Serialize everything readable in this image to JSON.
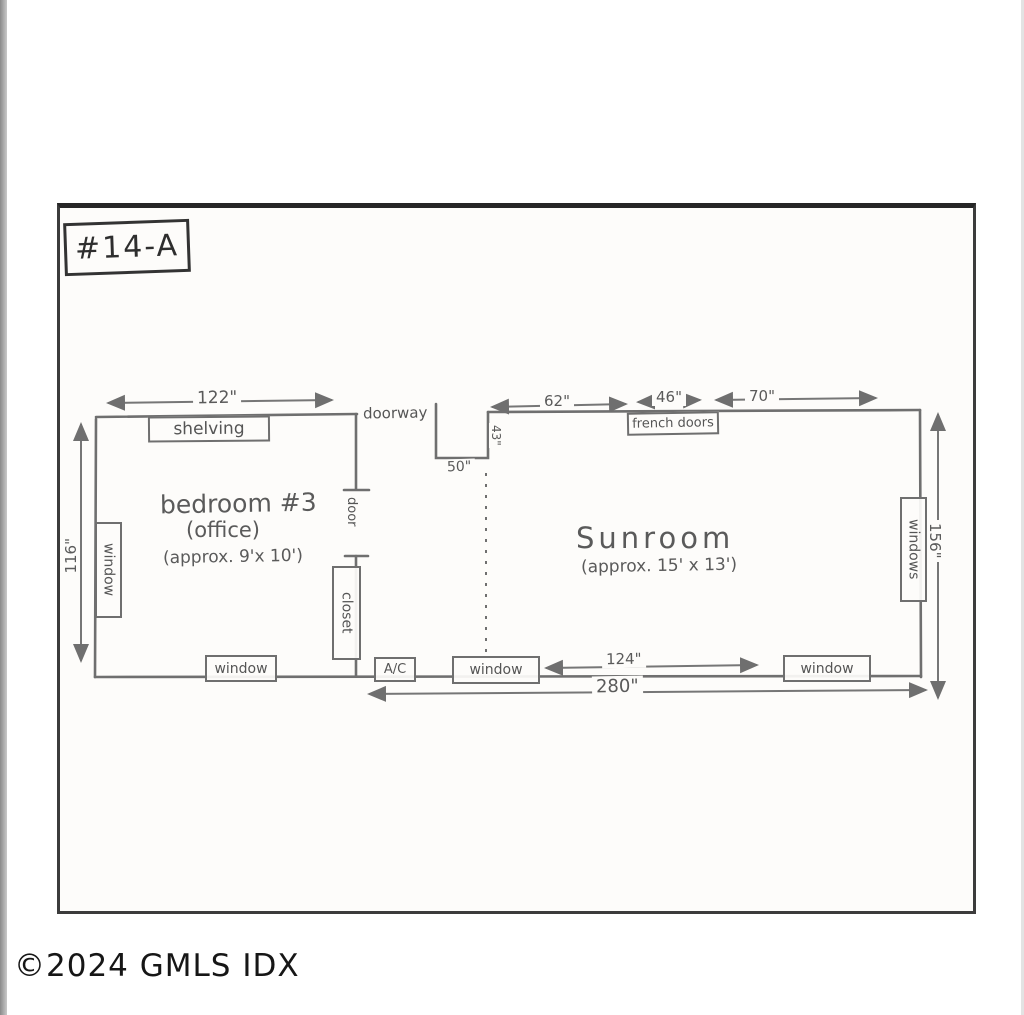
{
  "page": {
    "watermark": "©2024 GMLS IDX"
  },
  "plan": {
    "sheet_label": "#14-A",
    "rooms": {
      "bedroom": {
        "name": "bedroom #3",
        "subname": "(office)",
        "approx": "(approx. 9'x 10')"
      },
      "sunroom": {
        "name": "Sunroom",
        "approx": "(approx. 15' x 13')"
      }
    },
    "features": {
      "shelving": "shelving",
      "doorway": "doorway",
      "french_doors": "french doors",
      "windows_right": "windows",
      "window_left": "window",
      "door": "door",
      "closet": "closet",
      "window_bottom_bedroom": "window",
      "ac": "A/C",
      "window_bottom_sunroom_left": "window",
      "window_bottom_sunroom_right": "window"
    },
    "dimensions": {
      "top_bedroom": "122\"",
      "top_sunroom_1": "62\"",
      "top_sunroom_2": "46\"",
      "top_sunroom_3": "70\"",
      "left_height": "116\"",
      "right_height": "156\"",
      "notch_width": "50\"",
      "notch_depth": "43\"",
      "bottom_sunroom": "124\"",
      "bottom_total": "280\""
    },
    "colors": {
      "pencil": "#6f6f6f",
      "ink": "#2e2e2e",
      "paper": "#fdfcfa"
    }
  }
}
